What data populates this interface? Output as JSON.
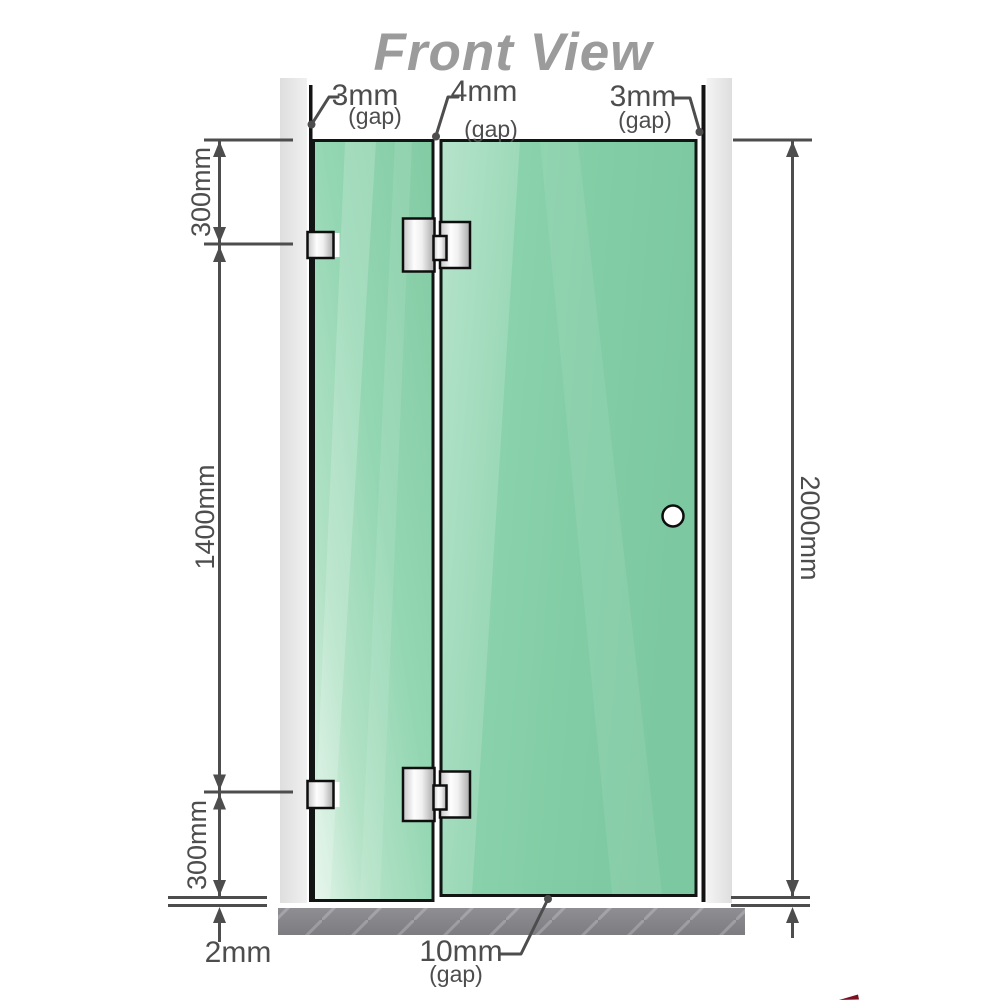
{
  "title": "Front View",
  "gaps": {
    "left": {
      "value": "3mm",
      "label": "(gap)"
    },
    "middle": {
      "value": "4mm",
      "label": "(gap)"
    },
    "right": {
      "value": "3mm",
      "label": "(gap)"
    },
    "bottom": {
      "value": "10mm",
      "label": "(gap)"
    },
    "floor": {
      "value": "2mm"
    }
  },
  "dimensions": {
    "top_segment": "300mm",
    "middle_segment": "1400mm",
    "bottom_segment": "300mm",
    "overall_height": "2000mm"
  },
  "colors": {
    "glass_green": "#8bd2ac",
    "glass_edge": "#111614",
    "wall_gray": "#e6e6e6",
    "floor_gray": "#85868b",
    "dimension_gray": "#4d4d4d",
    "title_gray": "#9b9b9b",
    "hardware_metal": "#d9d9d9",
    "watermark_red": "#7a1021"
  }
}
